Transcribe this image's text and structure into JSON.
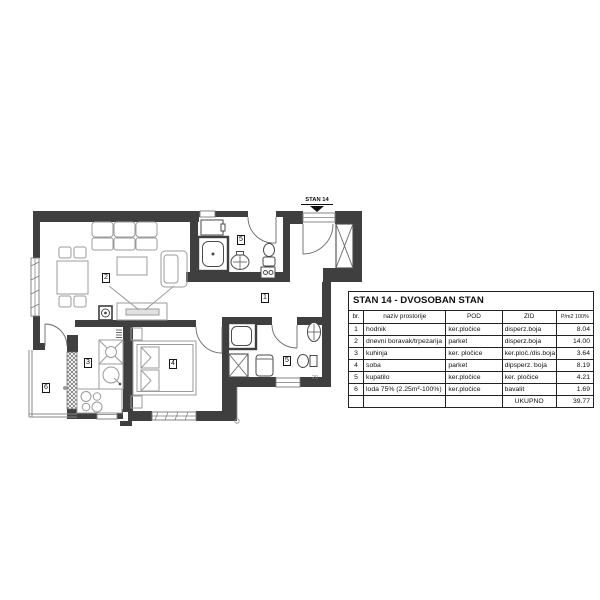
{
  "plan": {
    "entrance_label": "STAN 14",
    "dimension_label": "20",
    "room_numbers": {
      "hallway": "1",
      "living": "2",
      "kitchen": "3",
      "bedroom": "4",
      "bathroom_top": "5",
      "bathroom_bottom": "5",
      "loggia": "6"
    }
  },
  "table": {
    "title": "STAN  14 - DVOSOBAN STAN",
    "headers": {
      "br": "br.",
      "naziv": "naziv prostorije",
      "pod": "POD",
      "zid": "ZID",
      "pm2": "P/m2 100%"
    },
    "rows": [
      {
        "br": "1",
        "naziv": "hodnik",
        "pod": "ker.pločice",
        "zid": "disperz.boja",
        "pm2": "8.04"
      },
      {
        "br": "2",
        "naziv": "dnevni boravak/trpezarija",
        "pod": "parket",
        "zid": "disperz.boja",
        "pm2": "14.00"
      },
      {
        "br": "3",
        "naziv": "kuhinja",
        "pod": "ker. pločice",
        "zid": "ker.ploč./dis.boja",
        "pm2": "3.64"
      },
      {
        "br": "4",
        "naziv": "soba",
        "pod": "parket",
        "zid": "dipsperz. boja",
        "pm2": "8.19"
      },
      {
        "br": "5",
        "naziv": "kupatilo",
        "pod": "ker.pločice",
        "zid": "ker. pločice",
        "pm2": "4.21"
      },
      {
        "br": "6",
        "naziv": "loda 75%  (2.25m²-100%)",
        "pod": "ker.pločice",
        "zid": "bavalit",
        "pm2": "1.69"
      }
    ],
    "total_label": "UKUPNO",
    "total_value": "39.77"
  },
  "colors": {
    "wall": "#3f3f3f",
    "furniture": "#9b9b9b",
    "text": "#111111",
    "background": "#ffffff"
  }
}
